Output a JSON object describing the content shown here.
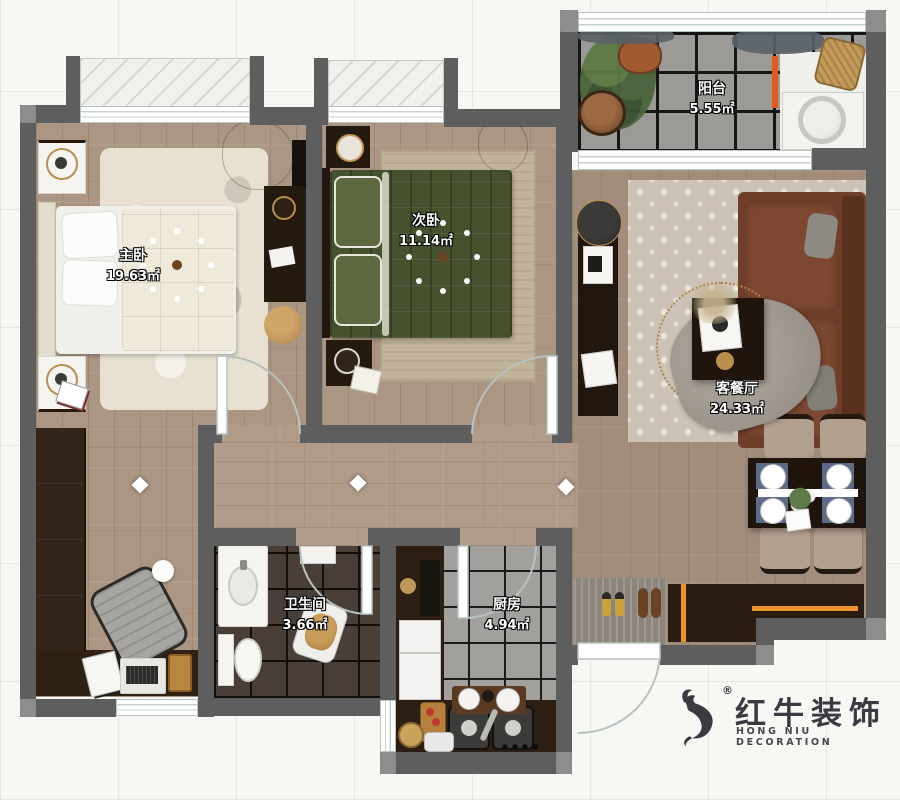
{
  "plan": {
    "rooms": [
      {
        "id": "master-bedroom",
        "name": "主卧",
        "area": "19.63㎡"
      },
      {
        "id": "second-bedroom",
        "name": "次卧",
        "area": "11.14㎡"
      },
      {
        "id": "balcony",
        "name": "阳台",
        "area": "5.55㎡"
      },
      {
        "id": "living-dining",
        "name": "客餐厅",
        "area": "24.33㎡"
      },
      {
        "id": "bathroom",
        "name": "卫生间",
        "area": "3.66㎡"
      },
      {
        "id": "kitchen",
        "name": "厨房",
        "area": "4.94㎡"
      }
    ]
  },
  "logo": {
    "brand_cn": "红牛装饰",
    "brand_en": "HONG NIU DECORATION",
    "registered_mark": "®"
  },
  "colors": {
    "wall": "#5e5e5e",
    "accent_orange": "#e8932c",
    "wood_floor": "#ab9684",
    "dark_tile": "#4a3f38",
    "gray_tile": "#a2a09d",
    "sofa": "#6e3e28"
  }
}
